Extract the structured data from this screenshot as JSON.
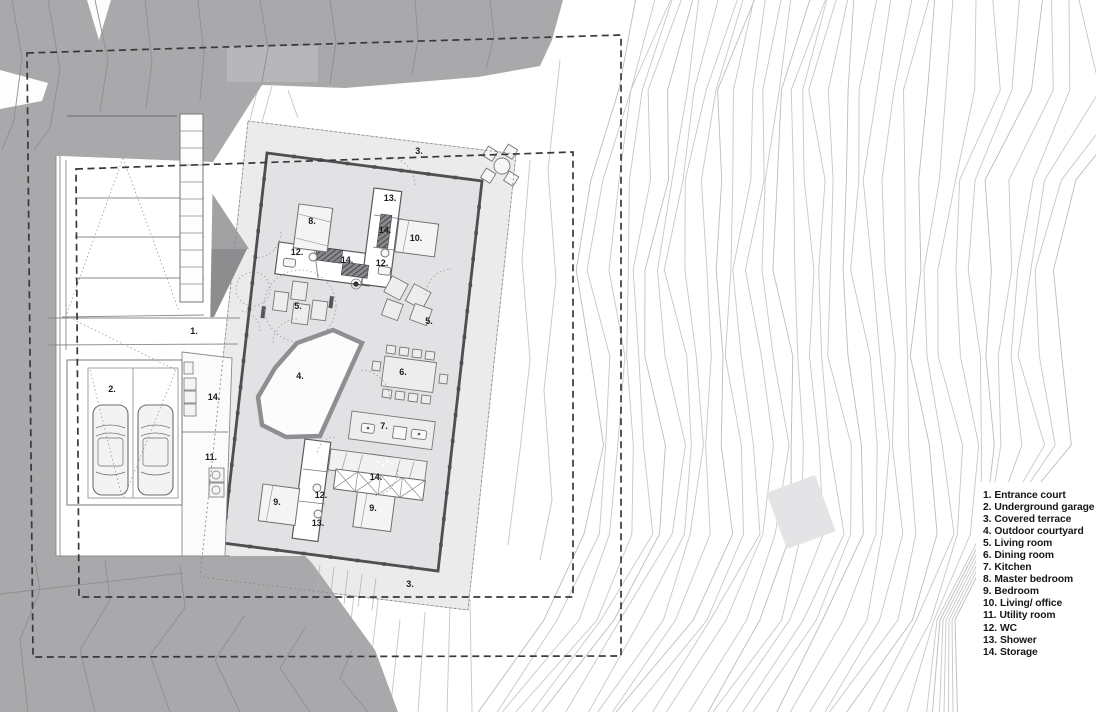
{
  "drawing": {
    "type": "architectural site and floor plan",
    "colors": {
      "background": "#ffffff",
      "terrain_gray": "#a9a9ab",
      "terrain_contour": "#8f8f92",
      "contour_line": "#c7c7c8",
      "terrace_fill": "#ebebec",
      "floor_fill": "#e2e2e4",
      "wall": "#4f4f52",
      "boundary_dash": "#39393c",
      "label_text": "#1c1c1f"
    }
  },
  "plan": {
    "labels": [
      {
        "text": "1."
      },
      {
        "text": "2."
      },
      {
        "text": "3."
      },
      {
        "text": "3."
      },
      {
        "text": "4."
      },
      {
        "text": "5."
      },
      {
        "text": "5."
      },
      {
        "text": "6."
      },
      {
        "text": "7."
      },
      {
        "text": "8."
      },
      {
        "text": "9."
      },
      {
        "text": "9."
      },
      {
        "text": "10."
      },
      {
        "text": "11."
      },
      {
        "text": "12."
      },
      {
        "text": "12."
      },
      {
        "text": "12."
      },
      {
        "text": "13."
      },
      {
        "text": "13."
      },
      {
        "text": "14."
      },
      {
        "text": "14."
      },
      {
        "text": "14."
      },
      {
        "text": "14."
      }
    ]
  },
  "legend": {
    "items": [
      {
        "num": "1.",
        "label": "Entrance court"
      },
      {
        "num": "2.",
        "label": "Underground garage"
      },
      {
        "num": "3.",
        "label": "Covered terrace"
      },
      {
        "num": "4.",
        "label": "Outdoor courtyard"
      },
      {
        "num": "5.",
        "label": "Living room"
      },
      {
        "num": "6.",
        "label": "Dining room"
      },
      {
        "num": "7.",
        "label": "Kitchen"
      },
      {
        "num": "8.",
        "label": "Master bedroom"
      },
      {
        "num": "9.",
        "label": "Bedroom"
      },
      {
        "num": "10.",
        "label": "Living/ office"
      },
      {
        "num": "11.",
        "label": "Utility room"
      },
      {
        "num": "12.",
        "label": "WC"
      },
      {
        "num": "13.",
        "label": "Shower"
      },
      {
        "num": "14.",
        "label": "Storage"
      }
    ]
  }
}
